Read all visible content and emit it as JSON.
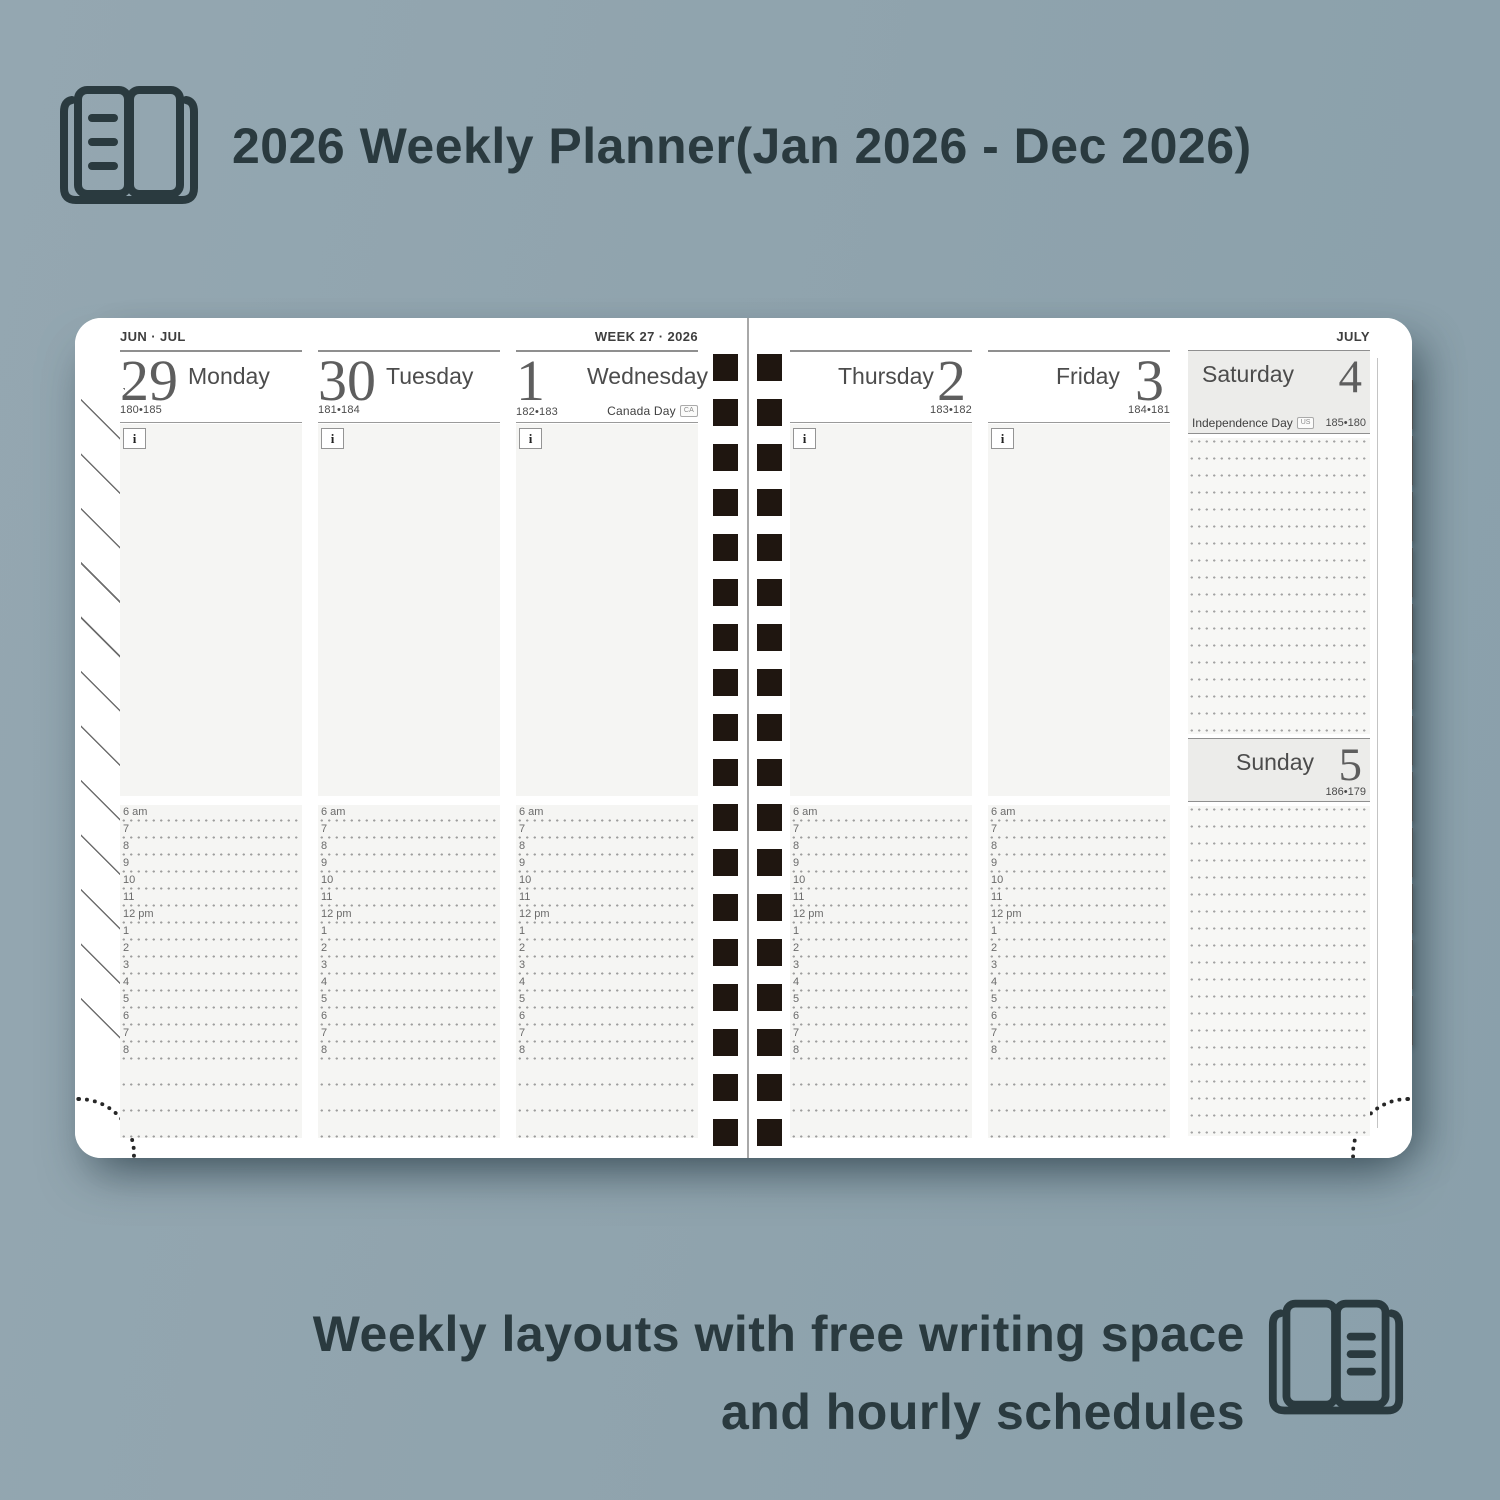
{
  "header": {
    "title": "2026 Weekly Planner(Jan 2026 - Dec 2026)"
  },
  "caption": {
    "line1": "Weekly layouts with free writing space",
    "line2": "and hourly schedules"
  },
  "planner": {
    "left_page": {
      "month_range": "JUN · JUL",
      "week_label": "WEEK 27 · 2026"
    },
    "right_page": {
      "month_label": "JULY"
    },
    "days": [
      {
        "number": "29",
        "name": "Monday",
        "day_of_year": "180•185"
      },
      {
        "number": "30",
        "name": "Tuesday",
        "day_of_year": "181•184"
      },
      {
        "number": "1",
        "name": "Wednesday",
        "day_of_year": "182•183",
        "holiday": "Canada Day",
        "holiday_badge": "CA"
      },
      {
        "number": "2",
        "name": "Thursday",
        "day_of_year": "183•182"
      },
      {
        "number": "3",
        "name": "Friday",
        "day_of_year": "184•181"
      },
      {
        "number": "4",
        "name": "Saturday",
        "day_of_year": "185•180",
        "holiday": "Independence Day",
        "holiday_badge": "US"
      },
      {
        "number": "5",
        "name": "Sunday",
        "day_of_year": "186•179"
      }
    ],
    "info_icon": "i",
    "hours": [
      "6 am",
      "7",
      "8",
      "9",
      "10",
      "11",
      "12 pm",
      "1",
      "2",
      "3",
      "4",
      "5",
      "6",
      "7",
      "8"
    ],
    "month_tabs": [
      "JAN",
      "FEB",
      "MAR",
      "APR",
      "MAY",
      "JUN",
      "JUL",
      "AUG",
      "SEP",
      "OCT",
      "NOV",
      "DEC"
    ]
  },
  "colors": {
    "background": "#92a5af",
    "heading_text": "#2a3a3f",
    "page_white": "#ffffff",
    "panel_gray": "#f5f5f3",
    "weekend_block_gray": "#ececea",
    "binding_black": "#1f1610",
    "rule_gray": "#8f8f8f"
  }
}
